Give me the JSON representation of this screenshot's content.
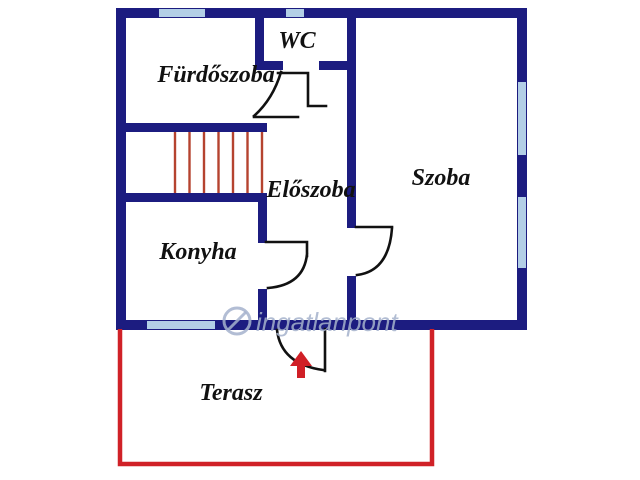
{
  "title": "Lakás alaprajz (floor plan)",
  "rooms": [
    {
      "id": "furdoszoba",
      "label": "Fürdőszoba"
    },
    {
      "id": "wc",
      "label": "WC"
    },
    {
      "id": "eloszoba",
      "label": "Előszoba"
    },
    {
      "id": "szoba",
      "label": "Szoba"
    },
    {
      "id": "konyha",
      "label": "Konyha"
    },
    {
      "id": "terasz",
      "label": "Terasz"
    }
  ],
  "watermark": {
    "text": "ingatlanpont",
    "logo": "circle-slash-icon"
  },
  "colors": {
    "wall": "#1c1c80",
    "window": "#b3cfe6",
    "terrace": "#d02127",
    "stairs": "#b5432f",
    "door": "#111111",
    "arrow": "#d01f26",
    "label": "#111111",
    "watermark": "#a5b2cc",
    "background": "#ffffff"
  }
}
